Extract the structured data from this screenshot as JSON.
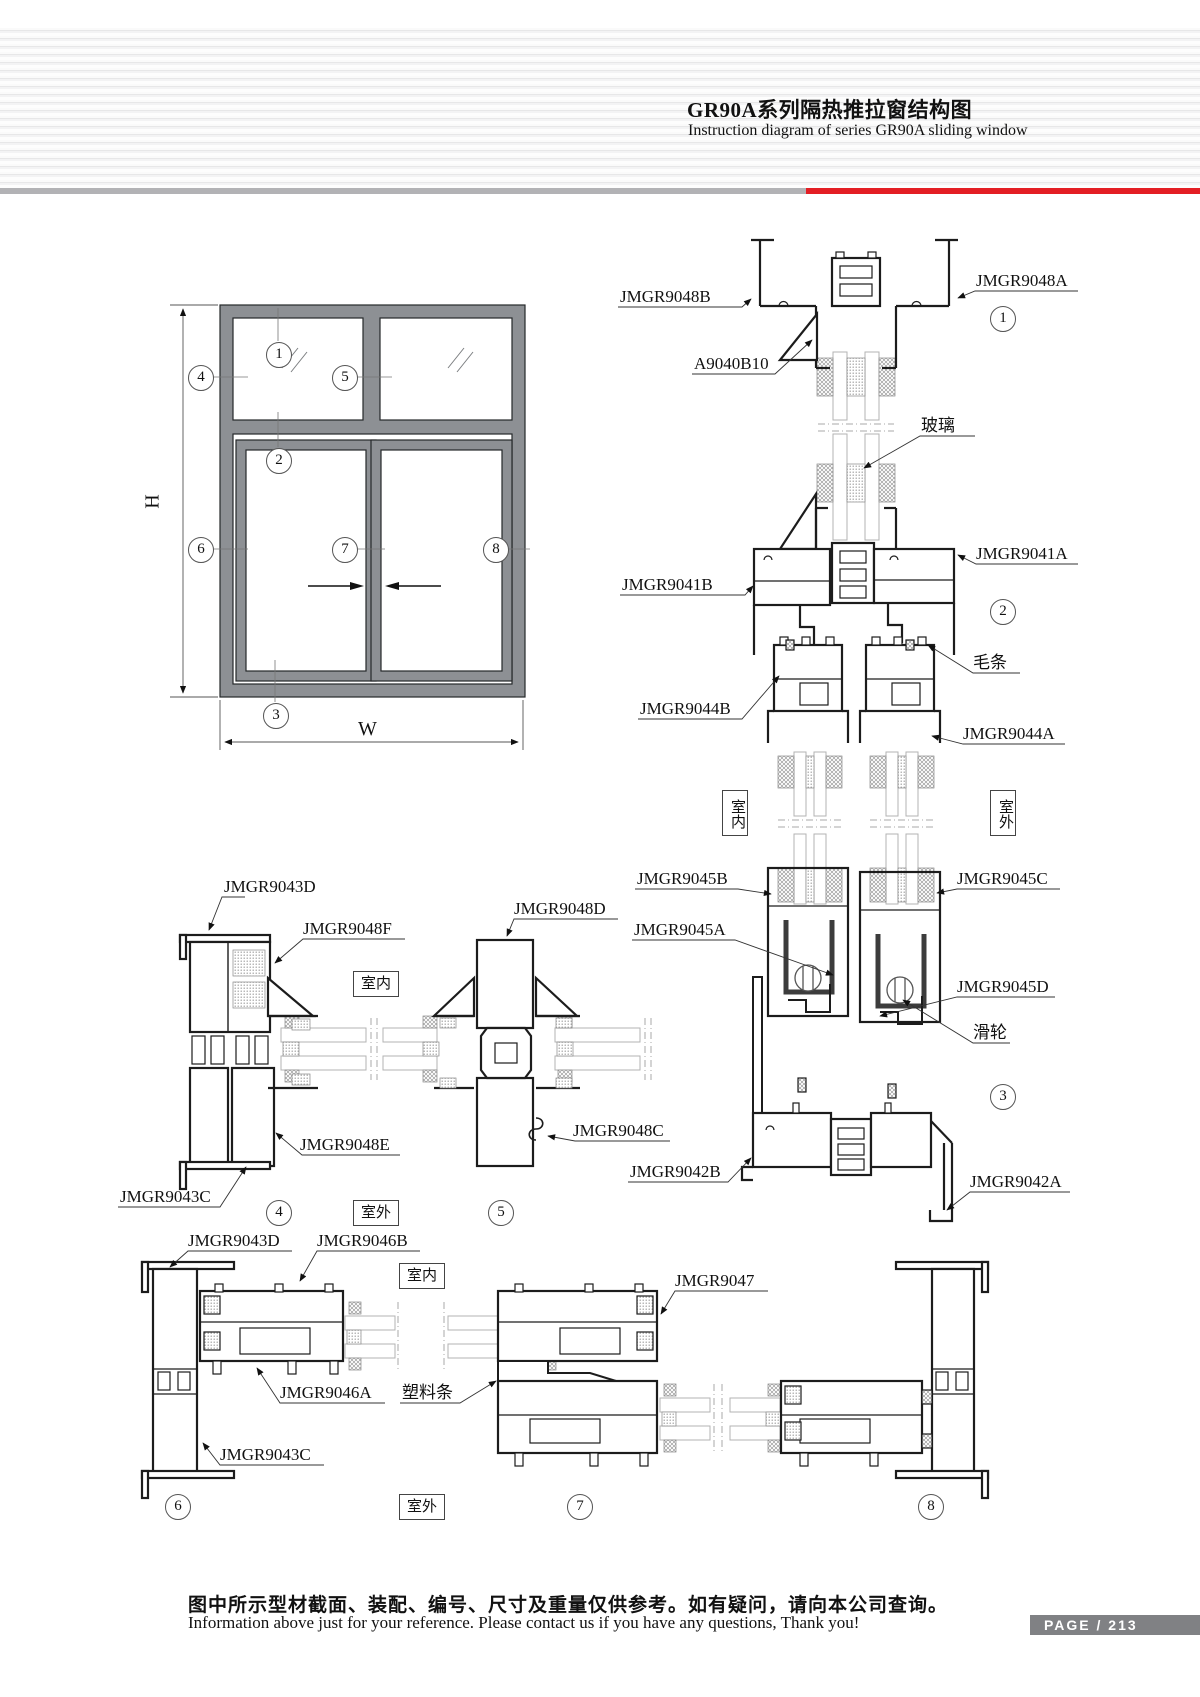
{
  "header": {
    "title": "GR90A系列隔热推拉窗结构图",
    "subtitle": "Instruction diagram of series GR90A sliding window"
  },
  "elevation": {
    "height_label": "H",
    "width_label": "W"
  },
  "rooms": {
    "indoor": "室内",
    "outdoor": "室外"
  },
  "callouts": {
    "c1": "1",
    "c2": "2",
    "c3": "3",
    "c4": "4",
    "c5": "5",
    "c6": "6",
    "c7": "7",
    "c8": "8"
  },
  "parts": {
    "jmgr9048b": "JMGR9048B",
    "jmgr9048a": "JMGR9048A",
    "a9040b10": "A9040B10",
    "glass": "玻璃",
    "jmgr9041b": "JMGR9041B",
    "jmgr9041a": "JMGR9041A",
    "wool": "毛条",
    "jmgr9044b": "JMGR9044B",
    "jmgr9044a": "JMGR9044A",
    "jmgr9045b": "JMGR9045B",
    "jmgr9045c": "JMGR9045C",
    "jmgr9045a": "JMGR9045A",
    "jmgr9045d": "JMGR9045D",
    "roller": "滑轮",
    "jmgr9048c": "JMGR9048C",
    "jmgr9042b": "JMGR9042B",
    "jmgr9042a": "JMGR9042A",
    "jmgr9043d": "JMGR9043D",
    "jmgr9048f": "JMGR9048F",
    "jmgr9048d": "JMGR9048D",
    "jmgr9048e": "JMGR9048E",
    "jmgr9043c": "JMGR9043C",
    "jmgr9046b": "JMGR9046B",
    "jmgr9046a": "JMGR9046A",
    "plastic": "塑料条",
    "jmgr9047": "JMGR9047"
  },
  "footer": {
    "note_cn": "图中所示型材截面、装配、编号、尺寸及重量仅供参考。如有疑问，请向本公司查询。",
    "note_en": "Information above just for your reference. Please contact us if you have any questions, Thank you!",
    "page": "PAGE / 213"
  }
}
